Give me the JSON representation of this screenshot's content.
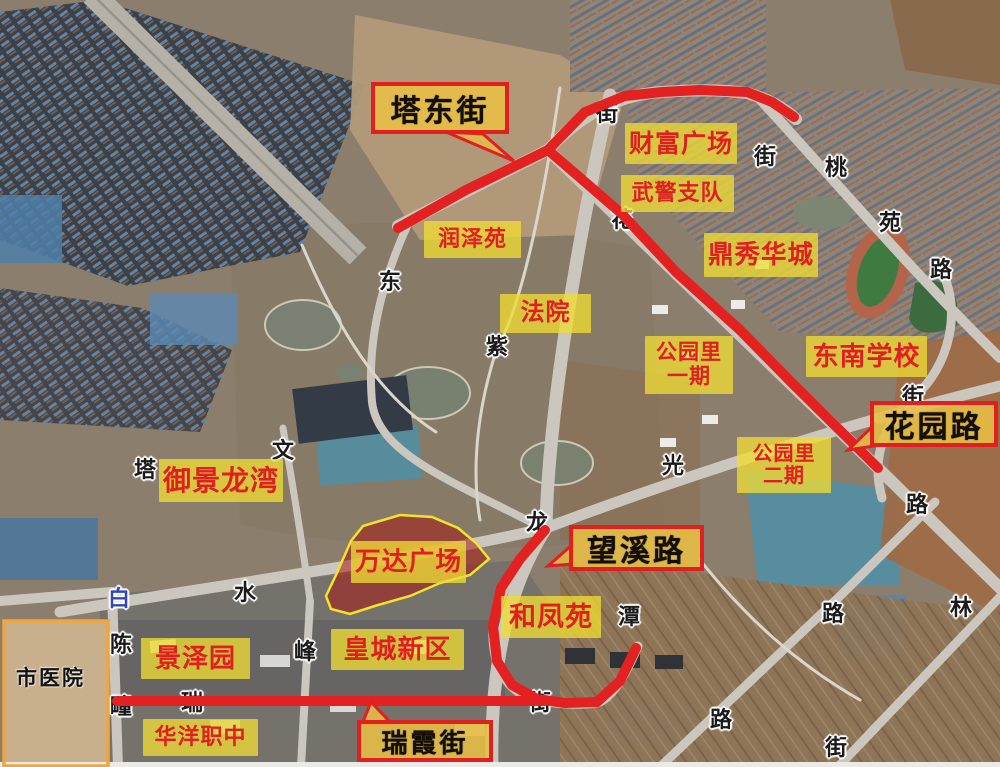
{
  "map": {
    "colors": {
      "highlight_road_red": "#e32120",
      "label_background_yellow": "rgba(238,219,52,0.78)",
      "label_text_red": "#e01f20",
      "callout_border_red": "#e01f20",
      "callout_background_amber": "rgba(232,191,70,0.88)",
      "callout_text_black": "#140f05",
      "road_char_black": "#1a1a1a",
      "road_char_blue": "#3347b5",
      "hospital_zone_orange": "#f0a63c",
      "wanda_zone_fill": "rgba(165,25,20,0.55)",
      "wanda_zone_outline": "#f2e42c"
    },
    "place_labels": [
      {
        "id": "caifu-guangchang",
        "lines": [
          "财富广场"
        ],
        "x": 625,
        "y": 123,
        "w": 112,
        "h": 41
      },
      {
        "id": "wujing-zhidui",
        "lines": [
          "武警支队"
        ],
        "x": 621,
        "y": 175,
        "w": 113,
        "h": 37
      },
      {
        "id": "dingxiu-huacheng",
        "lines": [
          "鼎秀华城"
        ],
        "x": 704,
        "y": 233,
        "w": 114,
        "h": 44
      },
      {
        "id": "runze-yuan",
        "lines": [
          "润泽苑"
        ],
        "x": 424,
        "y": 221,
        "w": 97,
        "h": 37
      },
      {
        "id": "fayuan",
        "lines": [
          "法院"
        ],
        "x": 500,
        "y": 294,
        "w": 91,
        "h": 39
      },
      {
        "id": "gongyuanli-yiqi",
        "lines": [
          "公园里",
          "一期"
        ],
        "x": 645,
        "y": 336,
        "w": 88,
        "h": 58
      },
      {
        "id": "dongnan-xuexiao",
        "lines": [
          "东南学校"
        ],
        "x": 806,
        "y": 336,
        "w": 121,
        "h": 41
      },
      {
        "id": "gongyuanli-erqi",
        "lines": [
          "公园里",
          "二期"
        ],
        "x": 737,
        "y": 437,
        "w": 94,
        "h": 56
      },
      {
        "id": "yujing-longwan",
        "lines": [
          "御景龙湾"
        ],
        "x": 159,
        "y": 459,
        "w": 124,
        "h": 43
      },
      {
        "id": "wanda-guangchang",
        "lines": [
          "万达广场"
        ],
        "x": 351,
        "y": 541,
        "w": 115,
        "h": 42
      },
      {
        "id": "hefeng-yuan",
        "lines": [
          "和凤苑"
        ],
        "x": 501,
        "y": 596,
        "w": 100,
        "h": 42
      },
      {
        "id": "huangcheng-xinqu",
        "lines": [
          "皇城新区"
        ],
        "x": 331,
        "y": 629,
        "w": 133,
        "h": 41
      },
      {
        "id": "jingze-yuan",
        "lines": [
          "景泽园"
        ],
        "x": 141,
        "y": 638,
        "w": 109,
        "h": 41
      },
      {
        "id": "huayang-zhizhong",
        "lines": [
          "华洋职中"
        ],
        "x": 143,
        "y": 719,
        "w": 115,
        "h": 37
      }
    ],
    "road_callouts": [
      {
        "id": "tadong-jie",
        "label": "塔东街",
        "x": 371,
        "y": 82,
        "w": 138,
        "h": 52,
        "pointer": "446,132 483,134 514,161"
      },
      {
        "id": "huayuan-lu",
        "label": "花园路",
        "x": 870,
        "y": 401,
        "w": 128,
        "h": 46,
        "pointer": "874,425 874,446 848,450"
      },
      {
        "id": "wangxi-lu",
        "label": "望溪路",
        "x": 569,
        "y": 525,
        "w": 135,
        "h": 46,
        "pointer": "573,544 573,564 548,566"
      },
      {
        "id": "ruixia-jie",
        "label": "瑞霞街",
        "x": 357,
        "y": 720,
        "w": 136,
        "h": 42,
        "pointer": "362,724 392,724 371,702"
      }
    ],
    "road_name_chars": [
      {
        "ch": "街",
        "x": 607,
        "y": 112
      },
      {
        "ch": "街",
        "x": 765,
        "y": 155
      },
      {
        "ch": "桃",
        "x": 836,
        "y": 166
      },
      {
        "ch": "苑",
        "x": 890,
        "y": 221
      },
      {
        "ch": "路",
        "x": 941,
        "y": 268
      },
      {
        "ch": "花",
        "x": 622,
        "y": 218
      },
      {
        "ch": "紫",
        "x": 497,
        "y": 345
      },
      {
        "ch": "东",
        "x": 390,
        "y": 280
      },
      {
        "ch": "光",
        "x": 673,
        "y": 464
      },
      {
        "ch": "文",
        "x": 283,
        "y": 449
      },
      {
        "ch": "塔",
        "x": 145,
        "y": 468
      },
      {
        "ch": "水",
        "x": 245,
        "y": 591
      },
      {
        "ch": "白",
        "x": 119,
        "y": 597,
        "color": "#3347b5"
      },
      {
        "ch": "龙",
        "x": 537,
        "y": 521
      },
      {
        "ch": "峰",
        "x": 305,
        "y": 650
      },
      {
        "ch": "陈",
        "x": 121,
        "y": 643
      },
      {
        "ch": "疃",
        "x": 121,
        "y": 705
      },
      {
        "ch": "瑞",
        "x": 192,
        "y": 701
      },
      {
        "ch": "街",
        "x": 540,
        "y": 701
      },
      {
        "ch": "潭",
        "x": 629,
        "y": 615
      },
      {
        "ch": "路",
        "x": 833,
        "y": 612
      },
      {
        "ch": "林",
        "x": 961,
        "y": 606
      },
      {
        "ch": "路",
        "x": 721,
        "y": 718
      },
      {
        "ch": "街",
        "x": 836,
        "y": 746
      },
      {
        "ch": "街",
        "x": 913,
        "y": 395
      },
      {
        "ch": "路",
        "x": 917,
        "y": 503
      }
    ],
    "red_roads": [
      {
        "id": "tadong-street-line",
        "points": "398,228 466,190 548,150 585,112 625,96 662,92 700,90 747,92 772,102 794,117"
      },
      {
        "id": "huayuan-road-line",
        "points": "548,150 622,214 676,272 740,330 792,383 878,468"
      },
      {
        "id": "wangxi-road-line",
        "points": "545,530 520,559 501,588 493,626 497,661 512,685 537,699 565,703 597,702 620,681 636,648"
      },
      {
        "id": "ruixia-street-line",
        "points": "117,701 300,701 545,701"
      }
    ],
    "zones": {
      "hospital": {
        "label": "市医院",
        "x": 4,
        "y": 621,
        "w": 104,
        "h": 145,
        "label_x": 16,
        "label_y": 662
      },
      "wanda_site": {
        "points": "363,526 400,515 432,517 458,528 476,543 489,559 470,575 440,583 410,596 378,605 350,614 331,609 326,596 336,575 351,541"
      }
    }
  }
}
